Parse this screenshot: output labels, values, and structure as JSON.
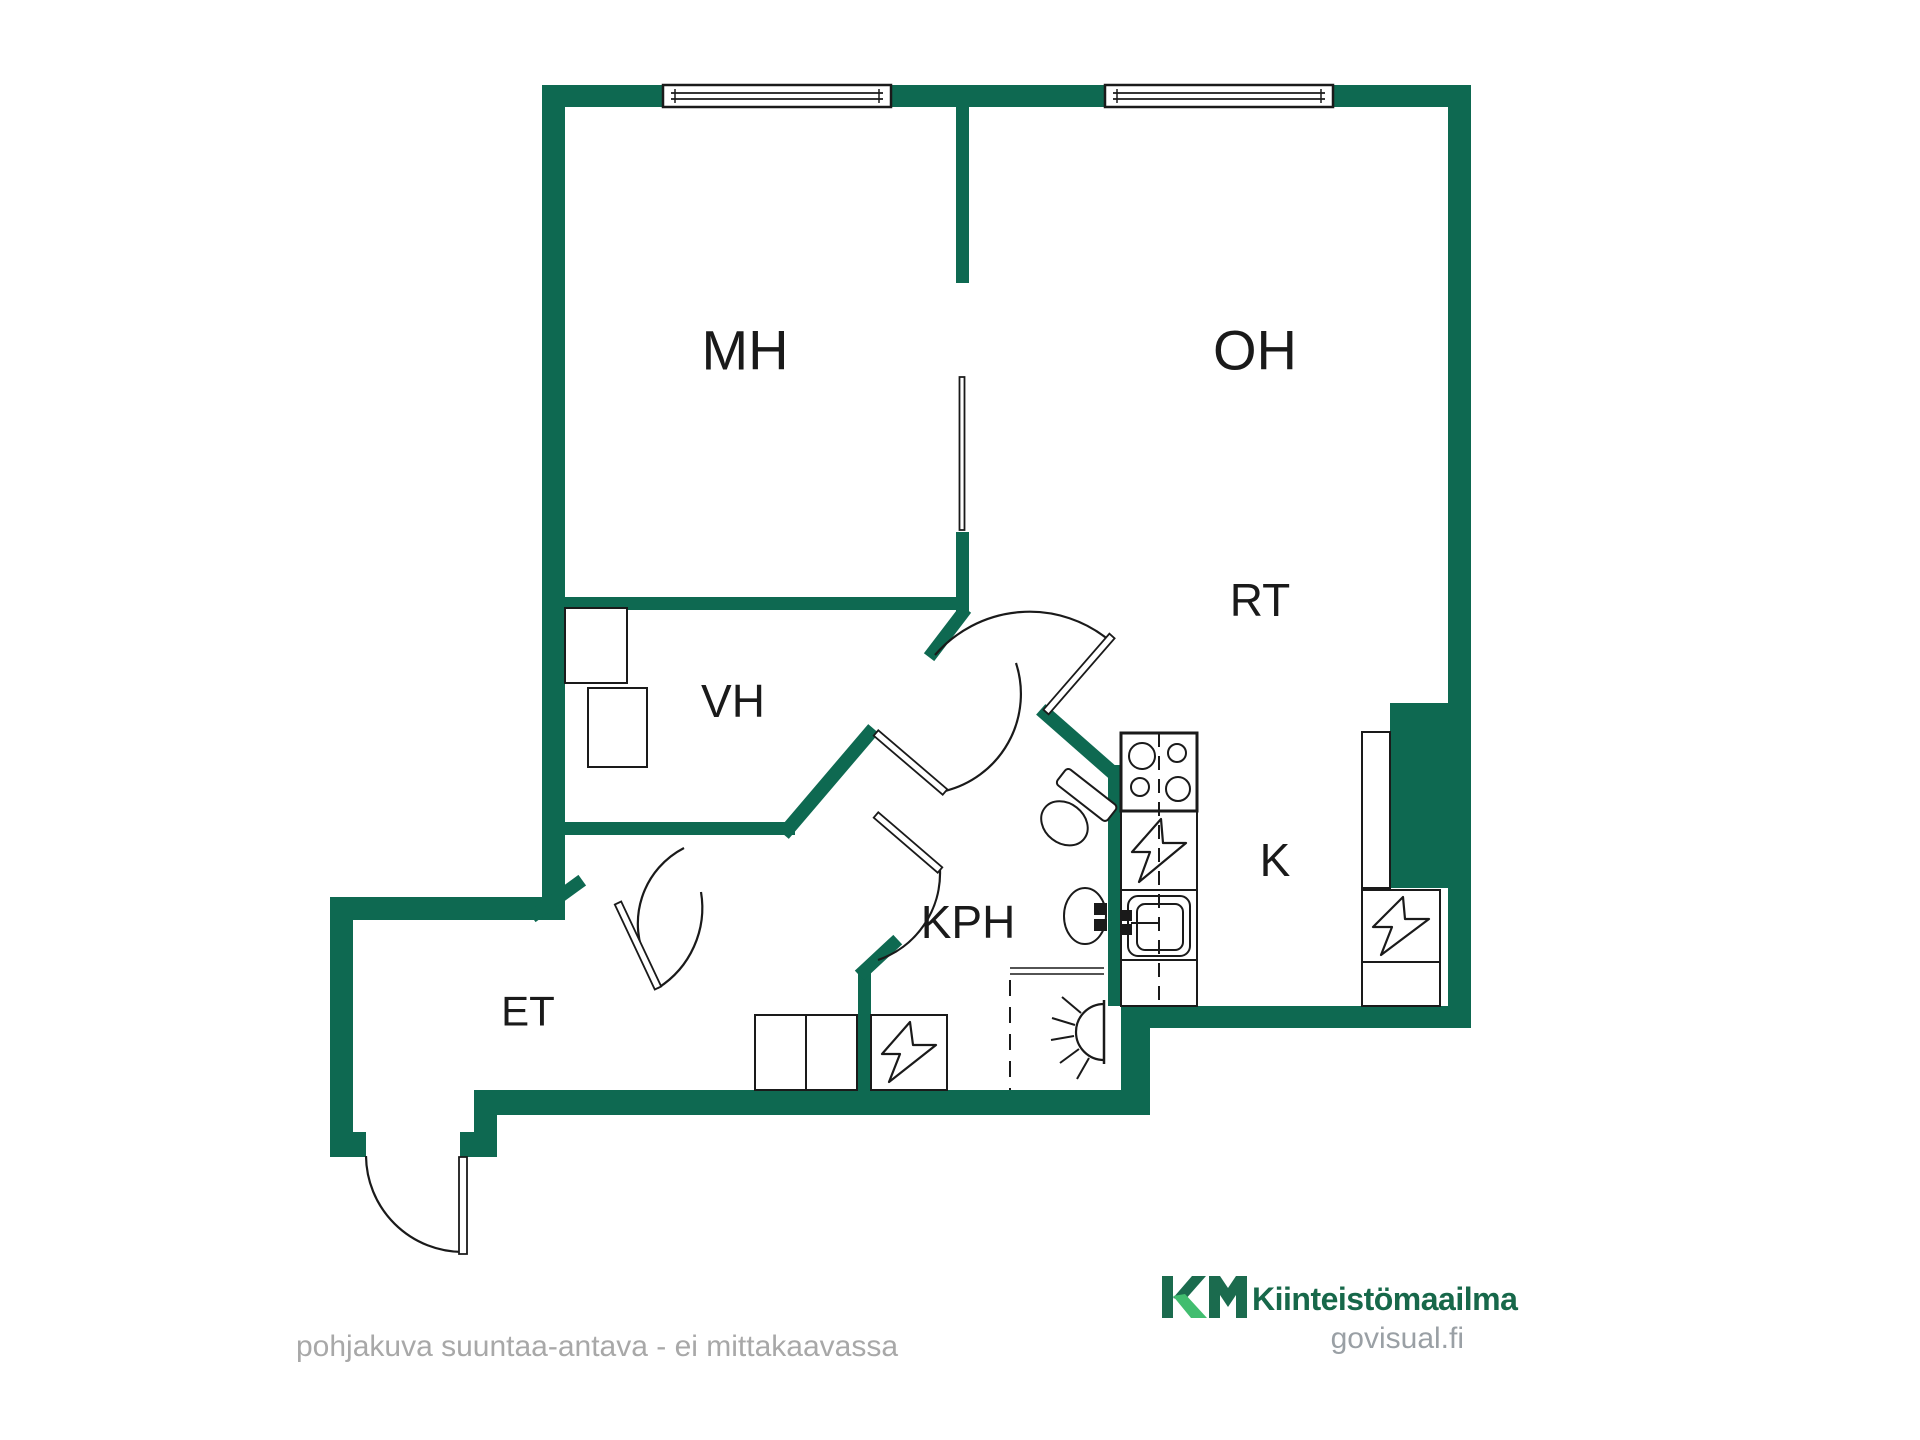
{
  "colors": {
    "wall": "#0e6951",
    "line": "#1a1a1a",
    "label": "#1a1a1a",
    "gray_text": "#a8a8a8",
    "site_text": "#9aa0a5",
    "logo_dark_green": "#1b6b4e",
    "logo_light_green": "#41bd6f",
    "logo_text_green": "#17684a"
  },
  "rooms": [
    {
      "id": "mh",
      "label": "MH",
      "x": 745,
      "y": 350,
      "size": 56
    },
    {
      "id": "oh",
      "label": "OH",
      "x": 1255,
      "y": 350,
      "size": 56
    },
    {
      "id": "rt",
      "label": "RT",
      "x": 1260,
      "y": 600,
      "size": 46
    },
    {
      "id": "vh",
      "label": "VH",
      "x": 733,
      "y": 701,
      "size": 46
    },
    {
      "id": "kph",
      "label": "KPH",
      "x": 968,
      "y": 922,
      "size": 46
    },
    {
      "id": "k",
      "label": "K",
      "x": 1275,
      "y": 860,
      "size": 46
    },
    {
      "id": "et",
      "label": "ET",
      "x": 528,
      "y": 1011,
      "size": 42
    }
  ],
  "footer": {
    "disclaimer": "pohjakuva suuntaa-antava - ei mittakaavassa",
    "brand": "Kiinteistömaailma",
    "site": "govisual.fi"
  },
  "plan": {
    "wall_rects": [
      [
        542,
        85,
        929,
        22
      ],
      [
        542,
        85,
        23,
        835
      ],
      [
        1448,
        85,
        23,
        943
      ],
      [
        956,
        107,
        13,
        176
      ],
      [
        956,
        532,
        13,
        80
      ],
      [
        565,
        597,
        398,
        13
      ],
      [
        565,
        822,
        230,
        13
      ],
      [
        330,
        897,
        235,
        23
      ],
      [
        330,
        897,
        23,
        260
      ],
      [
        330,
        1132,
        36,
        25
      ],
      [
        460,
        1132,
        37,
        25
      ],
      [
        474,
        1090,
        23,
        67
      ],
      [
        474,
        1090,
        676,
        25
      ],
      [
        1108,
        765,
        13,
        241
      ],
      [
        858,
        968,
        13,
        122
      ],
      [
        1121,
        1006,
        29,
        109
      ],
      [
        1121,
        1006,
        350,
        22
      ],
      [
        1390,
        703,
        81,
        185
      ]
    ],
    "wall_lines": [
      [
        788,
        829,
        869,
        734,
        14
      ],
      [
        962,
        614,
        933,
        652,
        13
      ],
      [
        1046,
        714,
        1112,
        772,
        14
      ],
      [
        537,
        913,
        577,
        884,
        13
      ],
      [
        864,
        971,
        893,
        944,
        13
      ]
    ],
    "windows": [
      [
        663,
        85,
        228,
        22
      ],
      [
        1105,
        85,
        228,
        22
      ]
    ],
    "door_arcs": [
      "M935 655 A125 125 0 0 1 1110 641",
      "M945 791 A100 100 0 0 0 1016 663",
      "M658 988 A95 95 0 0 0 701 892",
      "M940 870 A92 92 0 0 1 878 960",
      "M647 962 A85 85 0 0 1 684 848",
      "M366 1156 A97 97 0 0 0 463 1252"
    ],
    "door_leaves": [
      [
        1046,
        712,
        1112,
        636,
        7
      ],
      [
        876,
        733,
        945,
        792,
        7
      ],
      [
        618,
        903,
        658,
        988,
        7
      ],
      [
        876,
        815,
        940,
        870,
        7
      ],
      [
        463,
        1157,
        463,
        1254,
        8
      ],
      [
        962,
        377,
        962,
        530,
        5
      ]
    ],
    "fixtures": [
      {
        "t": "rect",
        "n": "vh-closet-1",
        "x": 565,
        "y": 608,
        "w": 62,
        "h": 75
      },
      {
        "t": "rect",
        "n": "vh-closet-2",
        "x": 588,
        "y": 688,
        "w": 59,
        "h": 79
      },
      {
        "t": "rect",
        "n": "et-wardrobe",
        "x": 755,
        "y": 1015,
        "w": 102,
        "h": 75
      },
      {
        "t": "line",
        "n": "et-wardrobe-divider",
        "x1": 806,
        "y1": 1015,
        "x2": 806,
        "y2": 1090
      },
      {
        "t": "rect",
        "n": "et-electrical-box",
        "x": 871,
        "y": 1015,
        "w": 76,
        "h": 75
      },
      {
        "t": "path",
        "n": "et-electrical-bolt",
        "d": "M910 1022 L882 1054 L900 1054 L889 1082 L936 1045 L913 1045 Z"
      },
      {
        "t": "rect",
        "n": "kitchen-counter",
        "x": 1121,
        "y": 733,
        "w": 76,
        "h": 273
      },
      {
        "t": "rect",
        "n": "stove",
        "x": 1121,
        "y": 733,
        "w": 76,
        "h": 78,
        "sw": 3
      },
      {
        "t": "circle",
        "n": "stove-burner",
        "cx": 1142,
        "cy": 756,
        "r": 13
      },
      {
        "t": "circle",
        "n": "stove-burner",
        "cx": 1177,
        "cy": 753,
        "r": 9
      },
      {
        "t": "circle",
        "n": "stove-burner",
        "cx": 1140,
        "cy": 787,
        "r": 9
      },
      {
        "t": "circle",
        "n": "stove-burner",
        "cx": 1178,
        "cy": 789,
        "r": 12
      },
      {
        "t": "line",
        "n": "counter-divider",
        "x1": 1121,
        "y1": 890,
        "x2": 1197,
        "y2": 890
      },
      {
        "t": "line",
        "n": "counter-divider",
        "x1": 1121,
        "y1": 960,
        "x2": 1197,
        "y2": 960
      },
      {
        "t": "path",
        "n": "counter-electrical-bolt",
        "d": "M1161 819 L1132 852 L1150 852 L1139 882 L1186 843 L1163 843 Z"
      },
      {
        "t": "rrect",
        "n": "kitchen-sink",
        "x": 1128,
        "y": 896,
        "w": 62,
        "h": 60,
        "r": 10
      },
      {
        "t": "rrect",
        "n": "kitchen-sink-basin",
        "x": 1137,
        "y": 904,
        "w": 46,
        "h": 46,
        "r": 8
      },
      {
        "t": "rect",
        "n": "sink-tap",
        "x": 1121,
        "y": 911,
        "w": 10,
        "h": 9,
        "f": "#1a1a1a"
      },
      {
        "t": "rect",
        "n": "sink-tap",
        "x": 1121,
        "y": 925,
        "w": 10,
        "h": 9,
        "f": "#1a1a1a"
      },
      {
        "t": "line",
        "n": "sink-tap-line",
        "x1": 1131,
        "y1": 923,
        "x2": 1160,
        "y2": 923
      },
      {
        "t": "line",
        "n": "counter-centerline",
        "x1": 1159,
        "y1": 733,
        "x2": 1159,
        "y2": 1006,
        "dash": "14 9"
      },
      {
        "t": "rect",
        "n": "kitchen-tall-cabinet",
        "x": 1362,
        "y": 732,
        "w": 28,
        "h": 156
      },
      {
        "t": "rect",
        "n": "kitchen-electrical-box",
        "x": 1362,
        "y": 890,
        "w": 78,
        "h": 72
      },
      {
        "t": "path",
        "n": "kitchen-electrical-bolt",
        "d": "M1403 897 L1373 927 L1392 927 L1381 955 L1429 919 L1405 919 Z"
      },
      {
        "t": "rect",
        "n": "kitchen-cabinet-low",
        "x": 1362,
        "y": 962,
        "w": 78,
        "h": 44
      },
      {
        "t": "g",
        "n": "toilet",
        "tr": "rotate(38 1078 806)",
        "items": [
          {
            "t": "rrect",
            "n": "toilet-tank",
            "x": 1046,
            "y": 782,
            "w": 64,
            "h": 20,
            "r": 4
          },
          {
            "t": "ellipse",
            "n": "toilet-bowl",
            "cx": 1078,
            "cy": 828,
            "rx": 25,
            "ry": 20
          }
        ]
      },
      {
        "t": "ellipse",
        "n": "washbasin",
        "cx": 1085,
        "cy": 916,
        "rx": 21,
        "ry": 28
      },
      {
        "t": "rect",
        "n": "washbasin-tap",
        "x": 1095,
        "y": 904,
        "w": 11,
        "h": 10,
        "f": "#1a1a1a"
      },
      {
        "t": "rect",
        "n": "washbasin-tap",
        "x": 1095,
        "y": 920,
        "w": 11,
        "h": 10,
        "f": "#1a1a1a"
      },
      {
        "t": "line",
        "n": "shower-glass",
        "x1": 1010,
        "y1": 968,
        "x2": 1104,
        "y2": 968,
        "sw": 1.5
      },
      {
        "t": "line",
        "n": "shower-glass",
        "x1": 1010,
        "y1": 974,
        "x2": 1104,
        "y2": 974,
        "sw": 1.5
      },
      {
        "t": "line",
        "n": "shower-edge",
        "x1": 1010,
        "y1": 980,
        "x2": 1010,
        "y2": 1090,
        "dash": "16 11"
      },
      {
        "t": "line",
        "n": "lamp-base",
        "x1": 1104,
        "y1": 1000,
        "x2": 1104,
        "y2": 1064,
        "sw": 2.5
      },
      {
        "t": "path",
        "n": "lamp-icon",
        "d": "M1104 1004 A28 28 0 0 0 1104 1060"
      },
      {
        "t": "line",
        "n": "lamp-ray",
        "x1": 1081,
        "y1": 1013,
        "x2": 1062,
        "y2": 997
      },
      {
        "t": "line",
        "n": "lamp-ray",
        "x1": 1075,
        "y1": 1025,
        "x2": 1052,
        "y2": 1018
      },
      {
        "t": "line",
        "n": "lamp-ray",
        "x1": 1074,
        "y1": 1036,
        "x2": 1051,
        "y2": 1040
      },
      {
        "t": "line",
        "n": "lamp-ray",
        "x1": 1079,
        "y1": 1049,
        "x2": 1060,
        "y2": 1063
      },
      {
        "t": "line",
        "n": "lamp-ray",
        "x1": 1089,
        "y1": 1058,
        "x2": 1077,
        "y2": 1079
      }
    ],
    "logo": [
      {
        "t": "rect",
        "n": "km-logo-k-stem",
        "x": 1162,
        "y": 1276,
        "w": 11,
        "h": 42,
        "f": "#1b6b4e",
        "sw": 0
      },
      {
        "t": "path",
        "n": "km-logo-k-arm",
        "d": "M1173 1298 L1192 1276 L1206 1276 L1184 1301 Z",
        "f": "#1b6b4e",
        "sw": 0
      },
      {
        "t": "path",
        "n": "km-logo-k-leg",
        "d": "M1173 1296 L1185 1294 L1207 1318 L1191 1318 Z",
        "f": "#41bd6f",
        "sw": 0
      },
      {
        "t": "path",
        "n": "km-logo-m",
        "d": "M1209 1318 L1209 1276 L1220 1276 L1228 1288 L1236 1276 L1247 1276 L1247 1318 L1236 1318 L1236 1295 L1228 1307 L1220 1295 L1220 1318 Z",
        "f": "#1b6b4e",
        "sw": 0
      }
    ]
  }
}
